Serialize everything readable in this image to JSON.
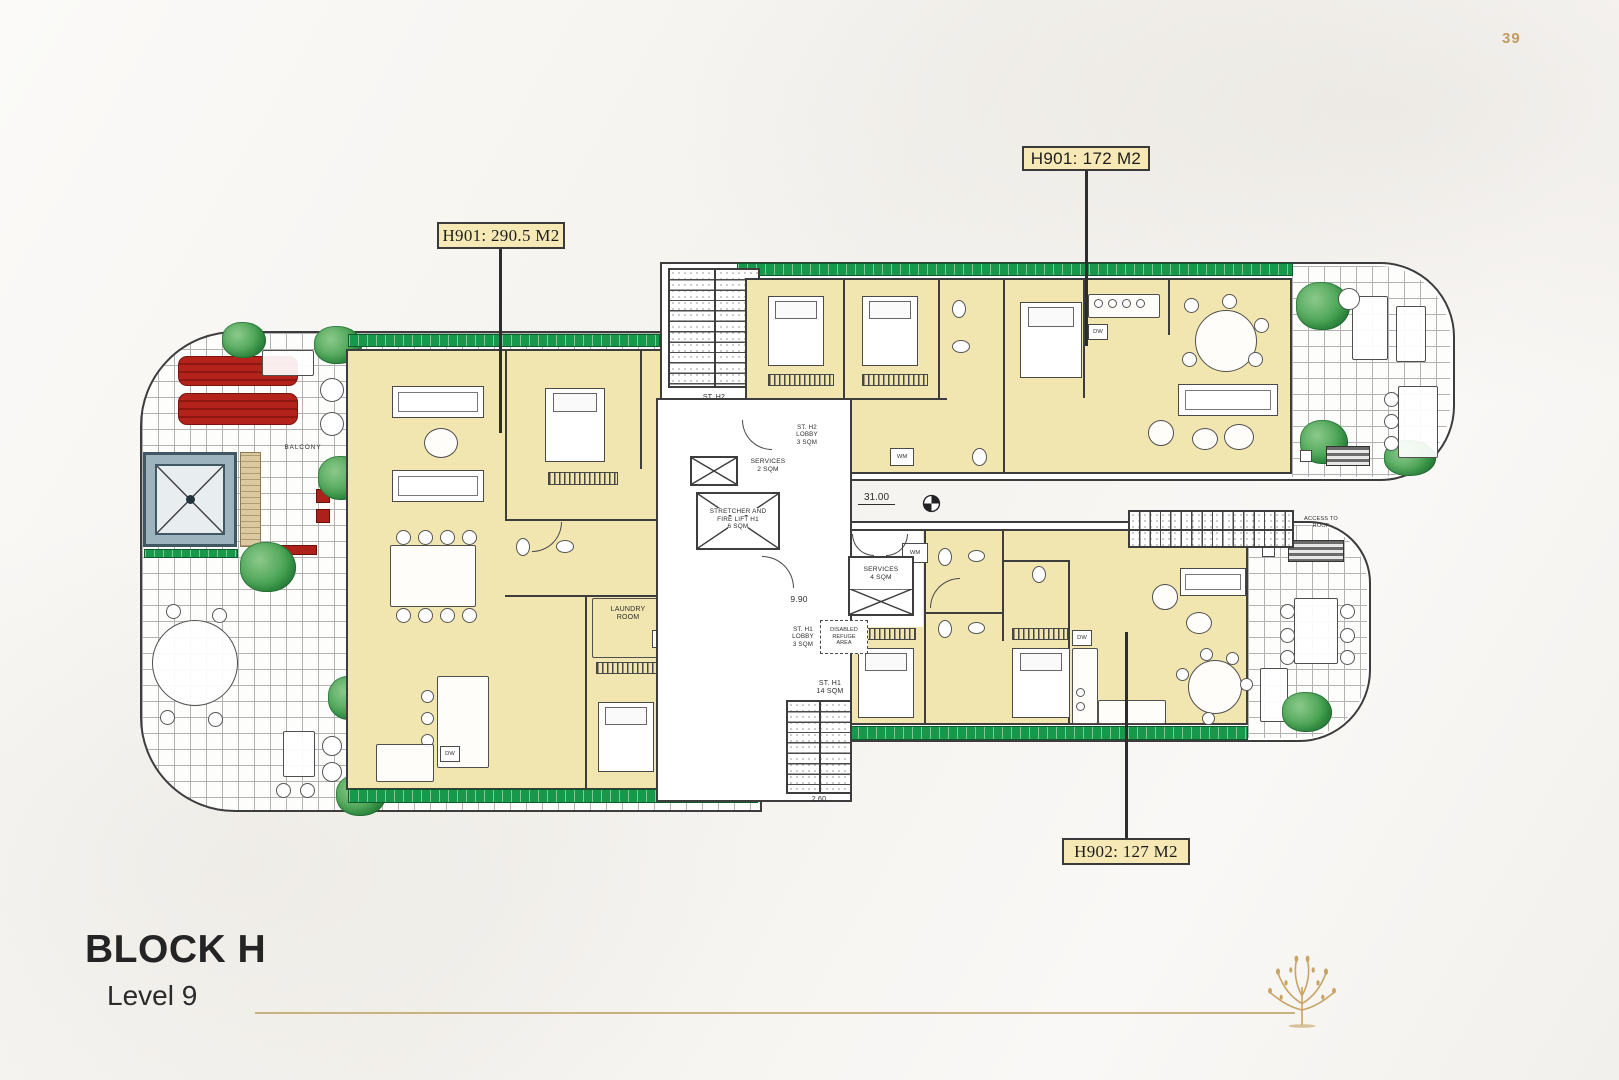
{
  "page": {
    "number": "39"
  },
  "footer": {
    "block_title": "BLOCK H",
    "level": "Level 9"
  },
  "unit_labels": [
    {
      "id": "h901-left",
      "text": "H901: 290.5 M2"
    },
    {
      "id": "h901-right",
      "text": "H901: 172 M2"
    },
    {
      "id": "h902",
      "text": "H902: 127 M2"
    }
  ],
  "core": {
    "stair_h2": [
      "ST. H2",
      "14 SQM"
    ],
    "stair_h2_lobby": [
      "ST. H2",
      "LOBBY",
      "3 SQM"
    ],
    "services_2": [
      "SERVICES",
      "2 SQM"
    ],
    "stretcher": [
      "STRETCHER AND",
      "FIRE LIFT H1",
      "6 SQM"
    ],
    "services_4": [
      "SERVICES",
      "4 SQM"
    ],
    "stair_h1_lobby": [
      "ST. H1",
      "LOBBY",
      "3 SQM"
    ],
    "disabled_refuge": [
      "DISABLED",
      "REFUGE",
      "AREA"
    ],
    "stair_h1": [
      "ST. H1",
      "14 SQM"
    ],
    "access_roof": [
      "ACCESS TO",
      "ROOF"
    ],
    "dim_31": "31.00",
    "dim_990": "9.90",
    "dim_260": "2.60"
  },
  "rooms": {
    "laundry": [
      "LAUNDRY",
      "ROOM"
    ],
    "wm": "WM",
    "dw": "DW",
    "balcony": "BALCONY"
  },
  "colors": {
    "accent_gold": "#c49a63",
    "unit_fill": "#f2e6b0",
    "label_fill": "#f6e9b5",
    "planter_green": "#17984a",
    "furniture_red": "#ae211a",
    "pool_blue": "#9db4bf",
    "line_dark": "#3d3d3d"
  }
}
